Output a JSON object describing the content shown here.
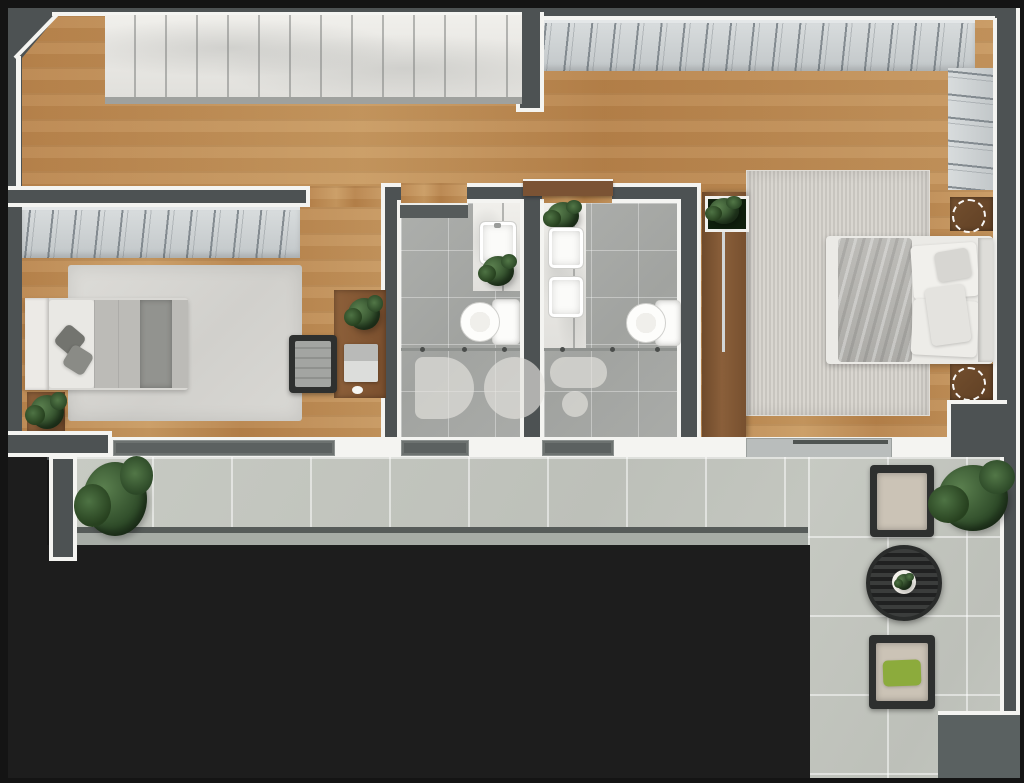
{
  "watermark": {
    "text": "DOF"
  },
  "palette": {
    "outside": "#161616",
    "wall": "#4d5253",
    "line": "#f4f4f1",
    "black": "#1d1d1d",
    "bottomRight": "#5a6161",
    "railDark": "#565b59",
    "railLight": "#a7aca6",
    "watermark": "rgba(229,228,223,0.65)",
    "pillowGreen": "#8cab3c",
    "woodFloor": "#bf8c55",
    "marble": "#eae9e5",
    "wardrobe": "#ced2d3",
    "bathTile": "#a9aba8",
    "terraceTile": "#c6c9c2",
    "rugLeft": "#d8d7d3",
    "rugRight": "#d0cdc7",
    "deskWood": "#8a5d38",
    "doorWood": "#7b5334"
  },
  "scene": {
    "rooms": [
      "top-suite",
      "bedroom-left",
      "bathroom-left",
      "bathroom-right",
      "bedroom-right",
      "terrace"
    ],
    "furniture": [
      "marble-wardrobe",
      "hanging-wardrobe",
      "single-bed",
      "double-bed",
      "desk",
      "desk-chair",
      "laptop",
      "mouse",
      "nightstand",
      "table-lamp",
      "dresser",
      "vanity-sink",
      "double-vanity",
      "toilet",
      "shower-screen",
      "rug",
      "outdoor-chair",
      "round-table",
      "potted-plant",
      "sliding-door",
      "window",
      "glass-railing"
    ]
  }
}
